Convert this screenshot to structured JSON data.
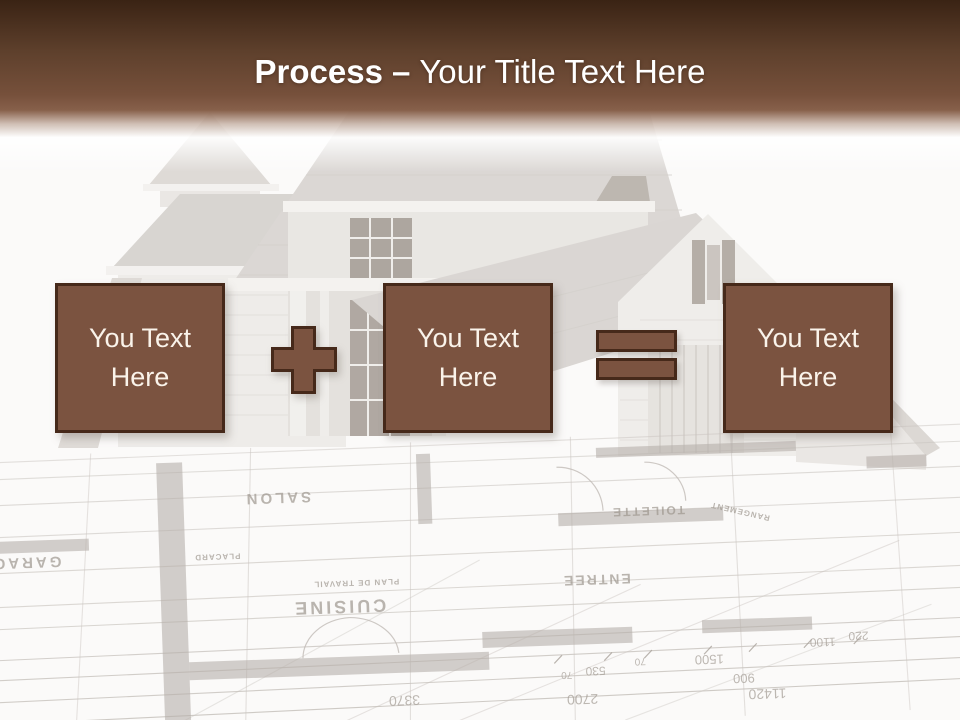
{
  "title": {
    "bold": "Process",
    "separator": "–",
    "rest": "Your Title Text Here"
  },
  "boxes": [
    {
      "label": "You Text Here"
    },
    {
      "label": "You Text Here"
    },
    {
      "label": "You Text Here"
    }
  ],
  "operators": [
    {
      "name": "plus-icon",
      "symbol": "+"
    },
    {
      "name": "equals-icon",
      "symbol": "="
    }
  ],
  "colors": {
    "header_top": "#3a2314",
    "header_brown": "#7a523d",
    "box_fill": "#7b5340",
    "box_border": "#46291a",
    "box_text": "#faf3ea",
    "title_text": "#ffffff"
  },
  "background": {
    "rooms": [
      "SALON",
      "CUISINE",
      "TOILETTE",
      "ENTREE",
      "GARAGE",
      "PLACARD",
      "PLAN DE TRAVAIL",
      "RANGEMENT"
    ],
    "dimensions": [
      "3370",
      "2700",
      "530",
      "70",
      "1500",
      "900",
      "11420",
      "1100",
      "220"
    ]
  }
}
